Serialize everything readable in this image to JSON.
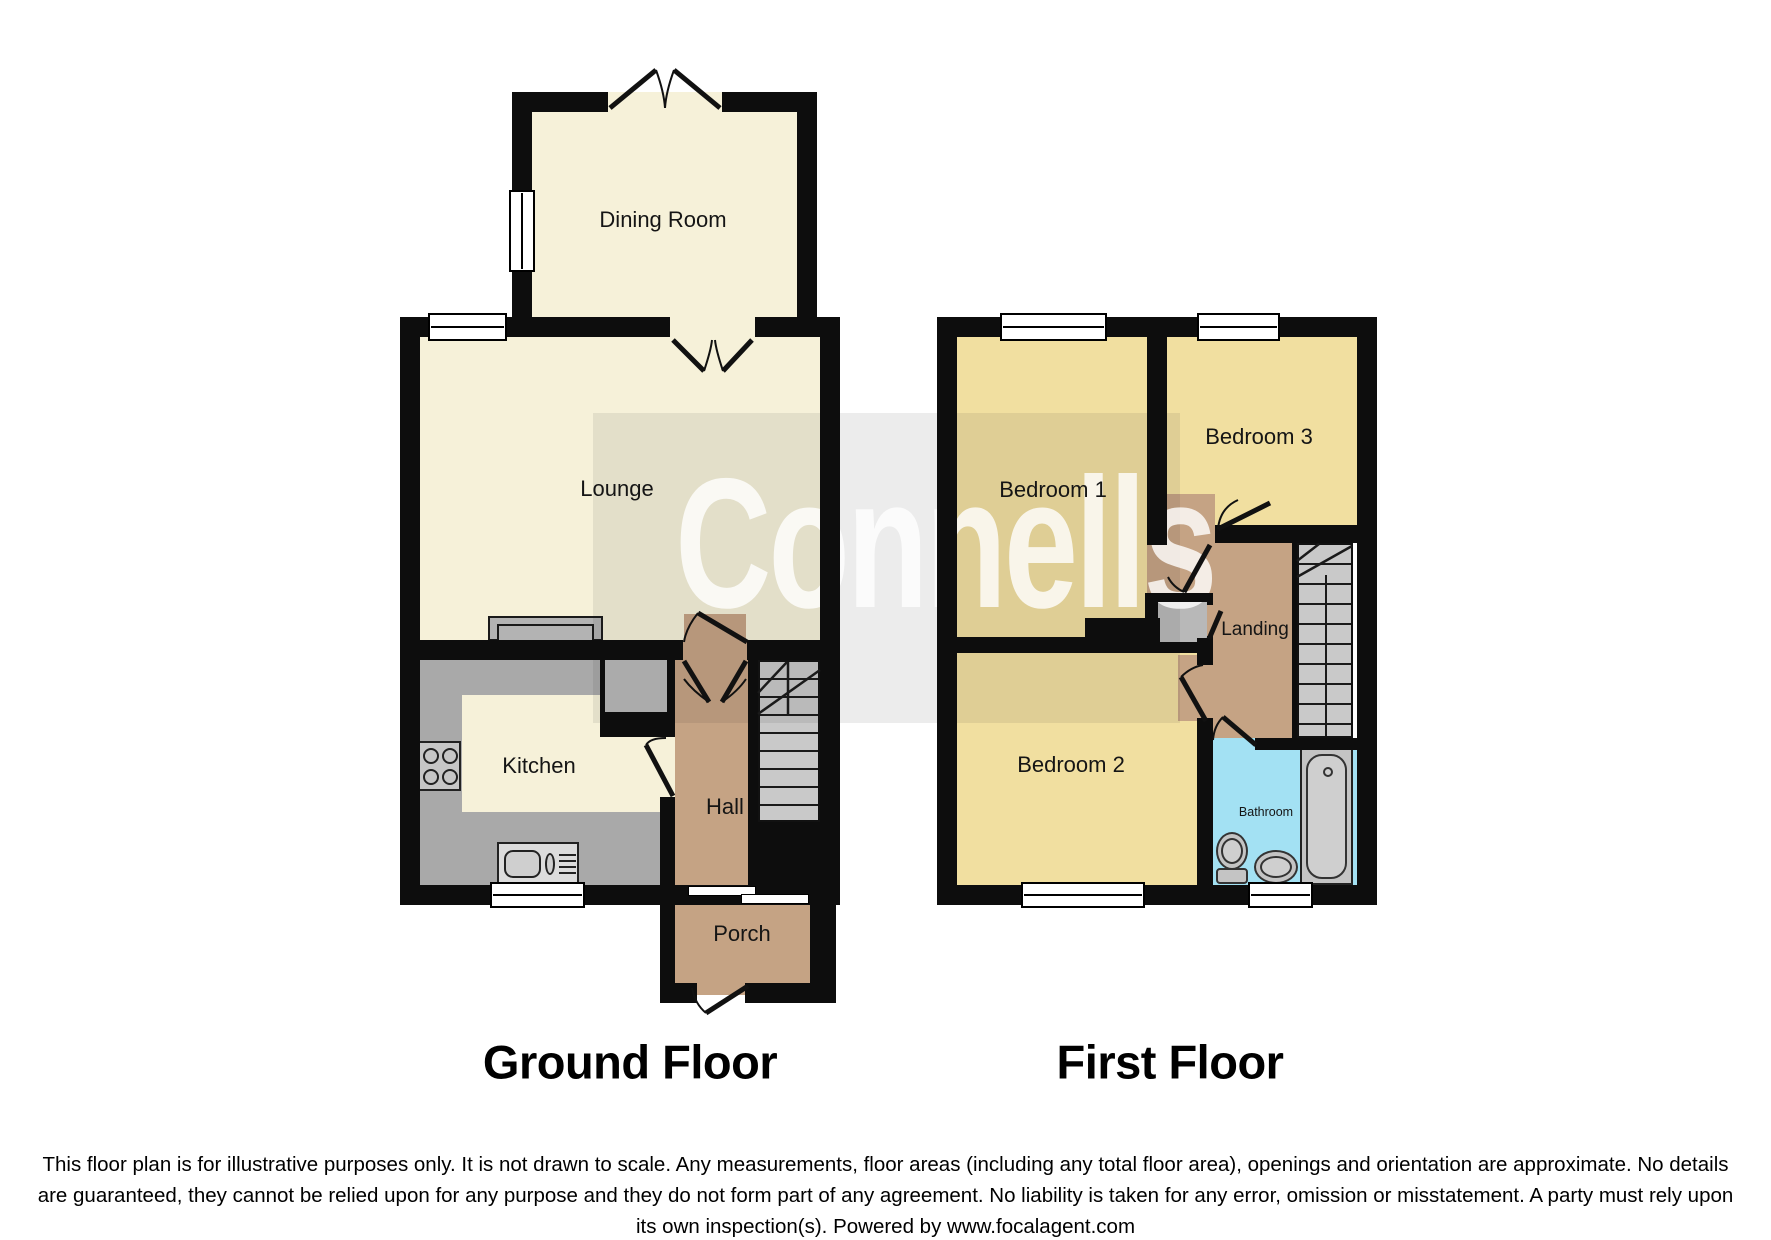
{
  "watermark": "Connells",
  "floor_titles": {
    "ground": "Ground Floor",
    "first": "First Floor"
  },
  "rooms": {
    "dining": "Dining Room",
    "lounge": "Lounge",
    "kitchen": "Kitchen",
    "hall": "Hall",
    "porch": "Porch",
    "bedroom1": "Bedroom 1",
    "bedroom2": "Bedroom 2",
    "bedroom3": "Bedroom 3",
    "landing": "Landing",
    "bathroom": "Bathroom"
  },
  "disclaimer": "This floor plan is for illustrative purposes only. It is not drawn to scale. Any measurements, floor areas (including any total floor area), openings and orientation are approximate. No details are guaranteed, they cannot be relied upon for any purpose and they do not form part of any agreement. No liability is taken for any error, omission or misstatement. A party must rely upon its own inspection(s). Powered by www.focalagent.com",
  "fixtures": [
    "staircase",
    "bath",
    "toilet",
    "wash-basin",
    "hob",
    "kitchen-sink",
    "fireplace",
    "storage-cupboard",
    "window",
    "door-swing",
    "sliding-door"
  ],
  "colors": {
    "wall": "#0d0d0d",
    "ground_floor_room": "#f6f1d9",
    "bedroom": "#f1dfa0",
    "hallway": "#c5a384",
    "bathroom": "#a3e1f3",
    "kitchen_counter": "#a9a9a9",
    "stairs": "#c9c9c9",
    "watermark_text": "rgba(255,255,255,0.8)"
  }
}
